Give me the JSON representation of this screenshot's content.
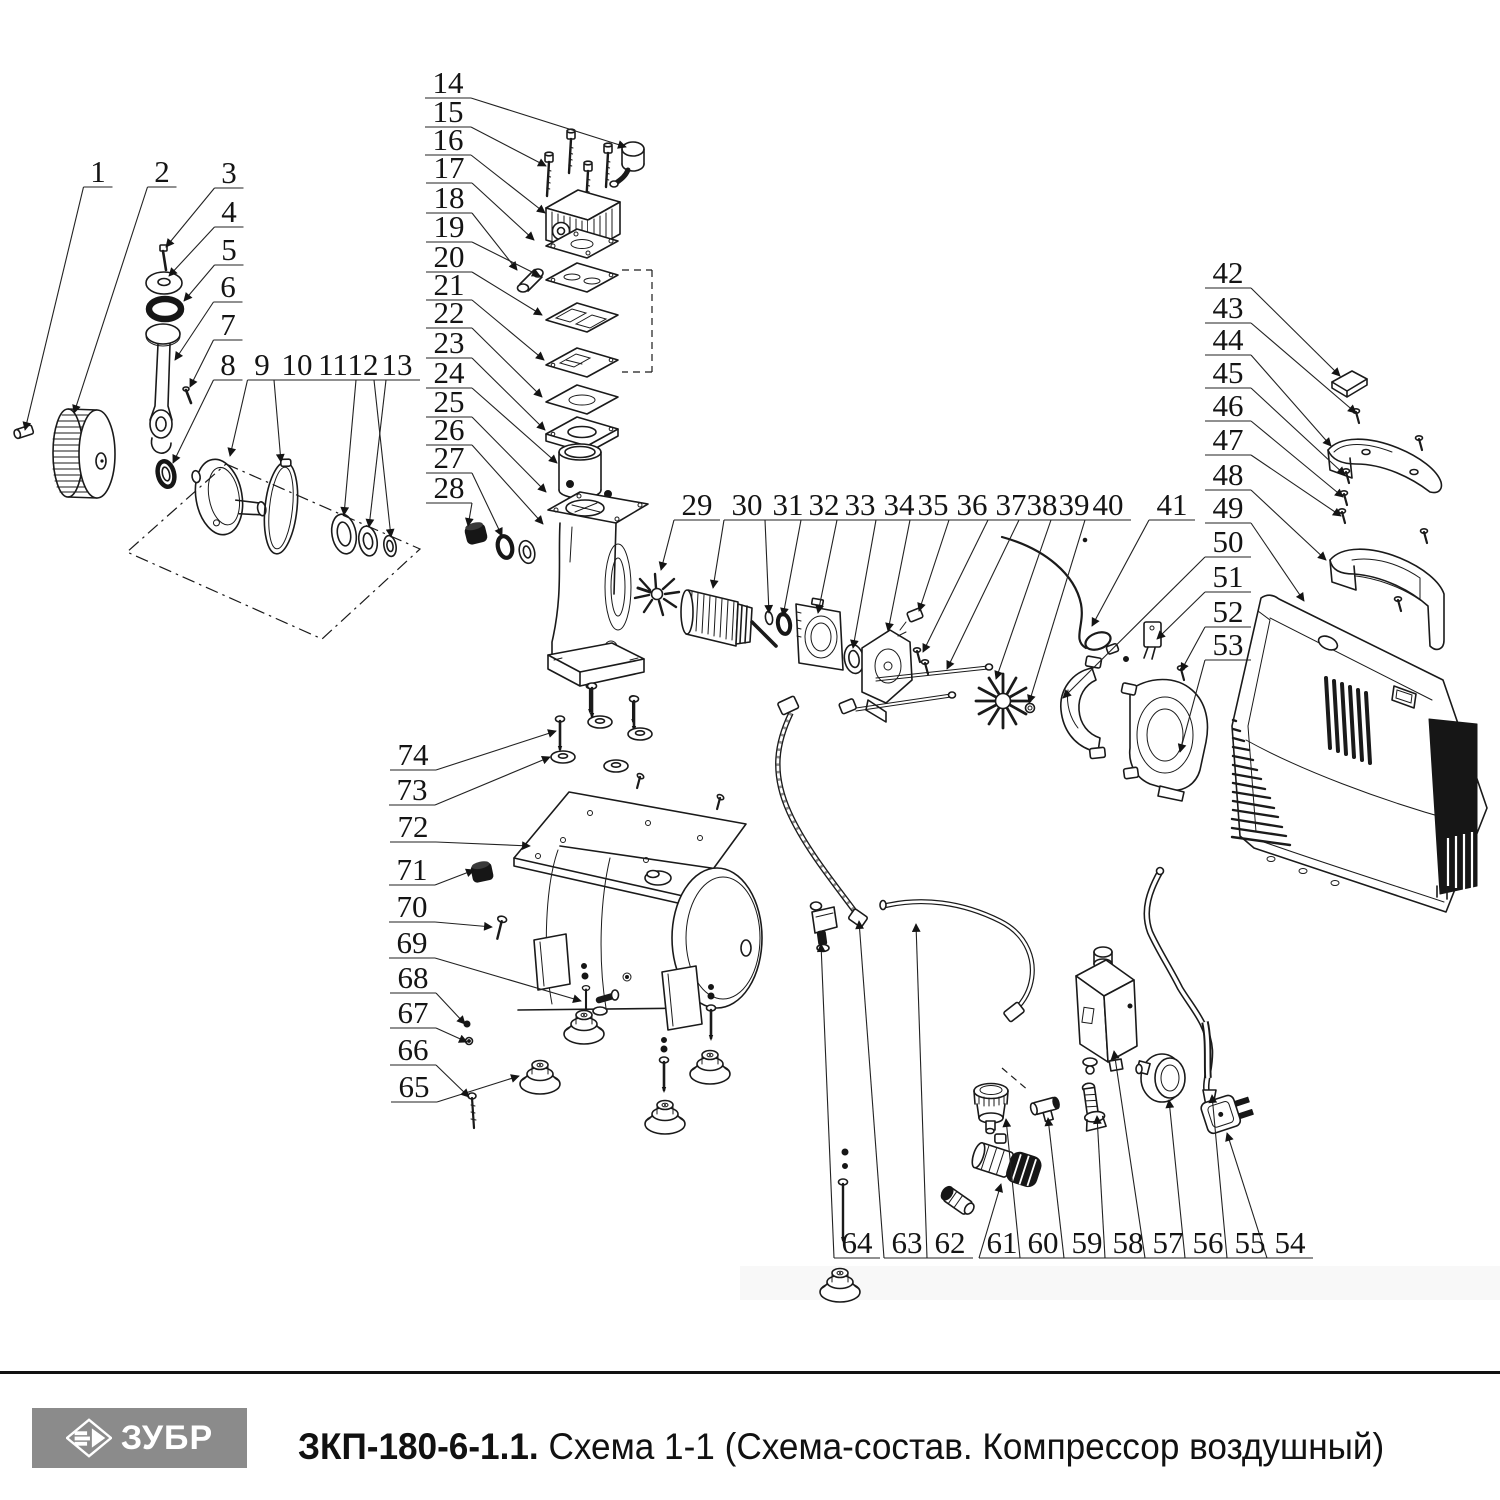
{
  "footer": {
    "brand": "ЗУБР",
    "model": "ЗКП-180-6-1.1.",
    "scheme": " Схема 1-1 (Схема-состав. Компрессор воздушный)"
  },
  "colors": {
    "line": "#1a1a1a",
    "logo_bg": "#8b8b8b",
    "logo_fg": "#ffffff",
    "band": "#f8f8f8",
    "text": "#111111"
  },
  "callouts": [
    {
      "n": "1",
      "x": 98,
      "y": 172,
      "tx": 25,
      "ty": 430
    },
    {
      "n": "2",
      "x": 162,
      "y": 172,
      "tx": 74,
      "ty": 413
    },
    {
      "n": "3",
      "x": 229,
      "y": 173,
      "tx": 166,
      "ty": 247
    },
    {
      "n": "4",
      "x": 229,
      "y": 212,
      "tx": 169,
      "ty": 276
    },
    {
      "n": "5",
      "x": 229,
      "y": 250,
      "tx": 184,
      "ty": 301
    },
    {
      "n": "6",
      "x": 228,
      "y": 287,
      "tx": 175,
      "ty": 360
    },
    {
      "n": "7",
      "x": 228,
      "y": 325,
      "tx": 190,
      "ty": 387
    },
    {
      "n": "8",
      "x": 228,
      "y": 365,
      "tx": 173,
      "ty": 463
    },
    {
      "n": "9",
      "x": 262,
      "y": 365,
      "tx": 230,
      "ty": 456
    },
    {
      "n": "10",
      "x": 297,
      "y": 365,
      "tx": 281,
      "ty": 462
    },
    {
      "n": "11",
      "x": 333,
      "y": 365,
      "tx": 344,
      "ty": 515
    },
    {
      "n": "12",
      "x": 363,
      "y": 365,
      "tx": 369,
      "ty": 527
    },
    {
      "n": "13",
      "x": 397,
      "y": 365,
      "tx": 391,
      "ty": 537
    },
    {
      "n": "14",
      "x": 448,
      "y": 83,
      "tx": 626,
      "ty": 147
    },
    {
      "n": "15",
      "x": 448,
      "y": 112,
      "tx": 546,
      "ty": 166
    },
    {
      "n": "16",
      "x": 448,
      "y": 140,
      "tx": 545,
      "ty": 213
    },
    {
      "n": "17",
      "x": 449,
      "y": 168,
      "tx": 534,
      "ty": 240
    },
    {
      "n": "18",
      "x": 449,
      "y": 198,
      "tx": 517,
      "ty": 270
    },
    {
      "n": "19",
      "x": 449,
      "y": 227,
      "tx": 540,
      "ty": 276
    },
    {
      "n": "20",
      "x": 449,
      "y": 257,
      "tx": 542,
      "ty": 315
    },
    {
      "n": "21",
      "x": 449,
      "y": 285,
      "tx": 544,
      "ty": 360
    },
    {
      "n": "22",
      "x": 449,
      "y": 313,
      "tx": 542,
      "ty": 397
    },
    {
      "n": "23",
      "x": 449,
      "y": 343,
      "tx": 545,
      "ty": 430
    },
    {
      "n": "24",
      "x": 449,
      "y": 373,
      "tx": 557,
      "ty": 463
    },
    {
      "n": "25",
      "x": 449,
      "y": 402,
      "tx": 546,
      "ty": 492
    },
    {
      "n": "26",
      "x": 449,
      "y": 430,
      "tx": 543,
      "ty": 524
    },
    {
      "n": "27",
      "x": 449,
      "y": 458,
      "tx": 502,
      "ty": 536
    },
    {
      "n": "28",
      "x": 449,
      "y": 488,
      "tx": 468,
      "ty": 526
    },
    {
      "n": "29",
      "x": 697,
      "y": 505,
      "tx": 661,
      "ty": 570
    },
    {
      "n": "30",
      "x": 747,
      "y": 505,
      "tx": 713,
      "ty": 588
    },
    {
      "n": "31",
      "x": 788,
      "y": 505,
      "tx": 769,
      "ty": 613
    },
    {
      "n": "32",
      "x": 824,
      "y": 505,
      "tx": 783,
      "ty": 616
    },
    {
      "n": "33",
      "x": 860,
      "y": 505,
      "tx": 818,
      "ty": 613
    },
    {
      "n": "34",
      "x": 899,
      "y": 505,
      "tx": 853,
      "ty": 648
    },
    {
      "n": "35",
      "x": 933,
      "y": 505,
      "tx": 888,
      "ty": 631
    },
    {
      "n": "36",
      "x": 972,
      "y": 505,
      "tx": 919,
      "ty": 611
    },
    {
      "n": "37",
      "x": 1011,
      "y": 505,
      "tx": 923,
      "ty": 652
    },
    {
      "n": "38",
      "x": 1042,
      "y": 505,
      "tx": 947,
      "ty": 669
    },
    {
      "n": "39",
      "x": 1074,
      "y": 505,
      "tx": 996,
      "ty": 679
    },
    {
      "n": "40",
      "x": 1108,
      "y": 505,
      "tx": 1029,
      "ty": 703
    },
    {
      "n": "41",
      "x": 1172,
      "y": 505,
      "tx": 1092,
      "ty": 626
    },
    {
      "n": "42",
      "x": 1228,
      "y": 273,
      "tx": 1340,
      "ty": 376
    },
    {
      "n": "43",
      "x": 1228,
      "y": 308,
      "tx": 1356,
      "ty": 413
    },
    {
      "n": "44",
      "x": 1228,
      "y": 340,
      "tx": 1331,
      "ty": 446
    },
    {
      "n": "45",
      "x": 1228,
      "y": 373,
      "tx": 1345,
      "ty": 475
    },
    {
      "n": "46",
      "x": 1228,
      "y": 406,
      "tx": 1343,
      "ty": 497
    },
    {
      "n": "47",
      "x": 1228,
      "y": 440,
      "tx": 1341,
      "ty": 516
    },
    {
      "n": "48",
      "x": 1228,
      "y": 475,
      "tx": 1326,
      "ty": 560
    },
    {
      "n": "49",
      "x": 1228,
      "y": 508,
      "tx": 1304,
      "ty": 601
    },
    {
      "n": "50",
      "x": 1228,
      "y": 542,
      "tx": 1063,
      "ty": 698
    },
    {
      "n": "51",
      "x": 1228,
      "y": 577,
      "tx": 1157,
      "ty": 639
    },
    {
      "n": "52",
      "x": 1228,
      "y": 612,
      "tx": 1181,
      "ty": 671
    },
    {
      "n": "53",
      "x": 1228,
      "y": 645,
      "tx": 1180,
      "ty": 752
    },
    {
      "n": "54",
      "x": 1290,
      "y": 1243,
      "tx": 1227,
      "ty": 1133
    },
    {
      "n": "55",
      "x": 1250,
      "y": 1243,
      "tx": 1212,
      "ty": 1095
    },
    {
      "n": "56",
      "x": 1208,
      "y": 1243,
      "tx": 1169,
      "ty": 1100
    },
    {
      "n": "57",
      "x": 1168,
      "y": 1243,
      "tx": 1114,
      "ty": 1051
    },
    {
      "n": "58",
      "x": 1128,
      "y": 1243,
      "tx": 1097,
      "ty": 1116
    },
    {
      "n": "59",
      "x": 1087,
      "y": 1243,
      "tx": 1048,
      "ty": 1118
    },
    {
      "n": "60",
      "x": 1043,
      "y": 1243,
      "tx": 1006,
      "ty": 1119
    },
    {
      "n": "61",
      "x": 1002,
      "y": 1243,
      "tx": 1001,
      "ty": 1184
    },
    {
      "n": "62",
      "x": 950,
      "y": 1243,
      "tx": 916,
      "ty": 924
    },
    {
      "n": "63",
      "x": 907,
      "y": 1243,
      "tx": 859,
      "ty": 921
    },
    {
      "n": "64",
      "x": 857,
      "y": 1243,
      "tx": 821,
      "ty": 944
    },
    {
      "n": "65",
      "x": 414,
      "y": 1087,
      "tx": 519,
      "ty": 1076
    },
    {
      "n": "66",
      "x": 413,
      "y": 1050,
      "tx": 469,
      "ty": 1097
    },
    {
      "n": "67",
      "x": 413,
      "y": 1013,
      "tx": 467,
      "ty": 1042
    },
    {
      "n": "68",
      "x": 413,
      "y": 978,
      "tx": 465,
      "ty": 1024
    },
    {
      "n": "69",
      "x": 412,
      "y": 943,
      "tx": 581,
      "ty": 1001
    },
    {
      "n": "70",
      "x": 412,
      "y": 907,
      "tx": 492,
      "ty": 927
    },
    {
      "n": "71",
      "x": 412,
      "y": 870,
      "tx": 474,
      "ty": 870
    },
    {
      "n": "72",
      "x": 413,
      "y": 827,
      "tx": 530,
      "ty": 846
    },
    {
      "n": "73",
      "x": 412,
      "y": 790,
      "tx": 550,
      "ty": 757
    },
    {
      "n": "74",
      "x": 413,
      "y": 755,
      "tx": 556,
      "ty": 731
    }
  ]
}
